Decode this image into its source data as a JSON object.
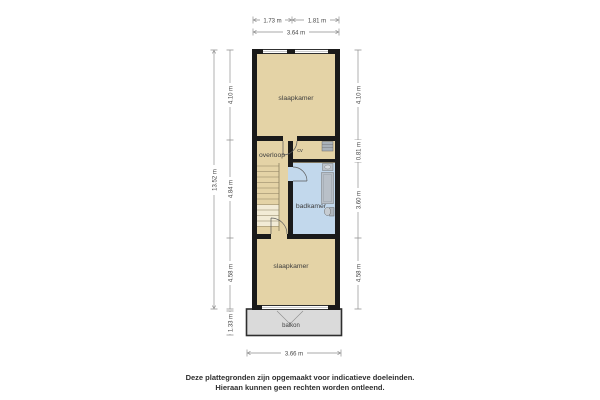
{
  "rooms": {
    "bedroom_top": "slaapkamer",
    "landing": "overloop",
    "cv_closet": "cv",
    "bathroom": "badkamer",
    "bedroom_bottom": "slaapkamer",
    "balcony": "balkon"
  },
  "dims": {
    "top_left_segment": "1.73 m",
    "top_right_segment": "1.81 m",
    "top_total": "3.64 m",
    "left_total": "13.52 m",
    "left_top": "4.10 m",
    "left_middle": "4.84 m",
    "left_bottom": "4.58 m",
    "left_balcony": "1.33 m",
    "right_top": "4.10 m",
    "right_cv": "0.81 m",
    "right_bathroom": "3.60 m",
    "right_bottom": "4.58 m",
    "bottom_total": "3.66 m"
  },
  "colors": {
    "room_fill": "#E4D3A6",
    "bathroom_fill": "#C2D8EC",
    "wall": "#1a1a1a",
    "balcony_fill": "#DADADA",
    "fixture_fill": "#B4BCC4",
    "dimension_line": "#8f8f8f"
  },
  "footer": {
    "line1": "Deze plattegronden zijn opgemaakt voor indicatieve doeleinden.",
    "line2": "Hieraan kunnen geen rechten worden ontleend."
  }
}
